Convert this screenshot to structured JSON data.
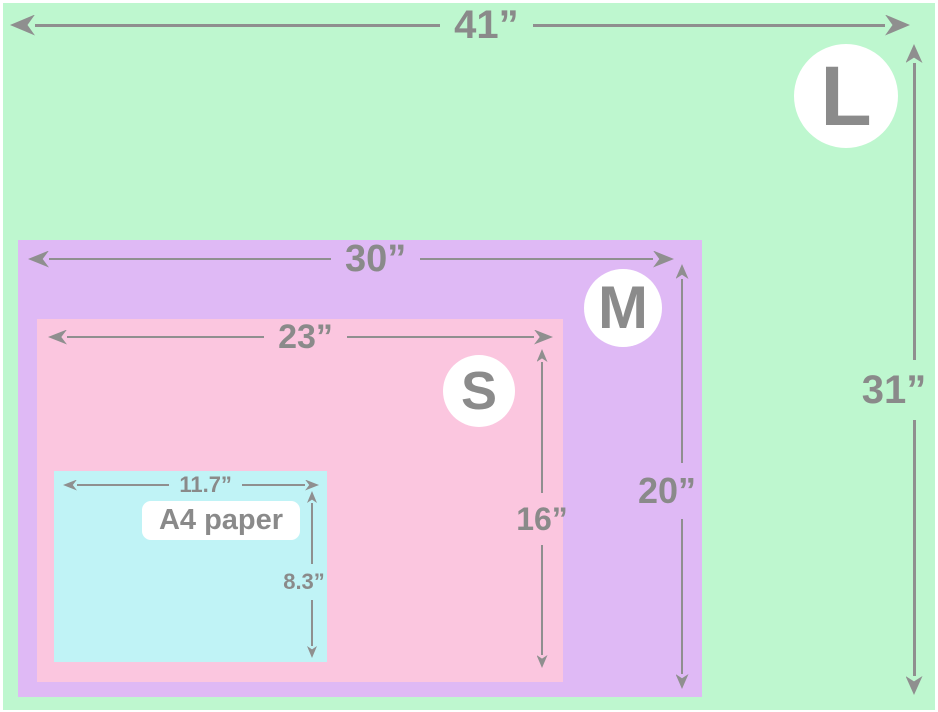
{
  "diagram": {
    "kind": "poster-size-comparison",
    "unit": "inches",
    "colors": {
      "size_l_fill": "#bef7cf",
      "size_m_fill": "#dfb9f5",
      "size_s_fill": "#fbc6df",
      "a4_fill": "#c0f3f6",
      "dimension_gray": "#8f8f8f",
      "label_gray": "#8a8a8a",
      "badge_bg": "#ffffff"
    },
    "sizes": [
      {
        "badge": "L",
        "width_label": "41”",
        "height_label": "31”"
      },
      {
        "badge": "M",
        "width_label": "30”",
        "height_label": "20”"
      },
      {
        "badge": "S",
        "width_label": "23”",
        "height_label": "16”"
      },
      {
        "name": "A4 paper",
        "width_label": "11.7”",
        "height_label": "8.3”"
      }
    ]
  }
}
